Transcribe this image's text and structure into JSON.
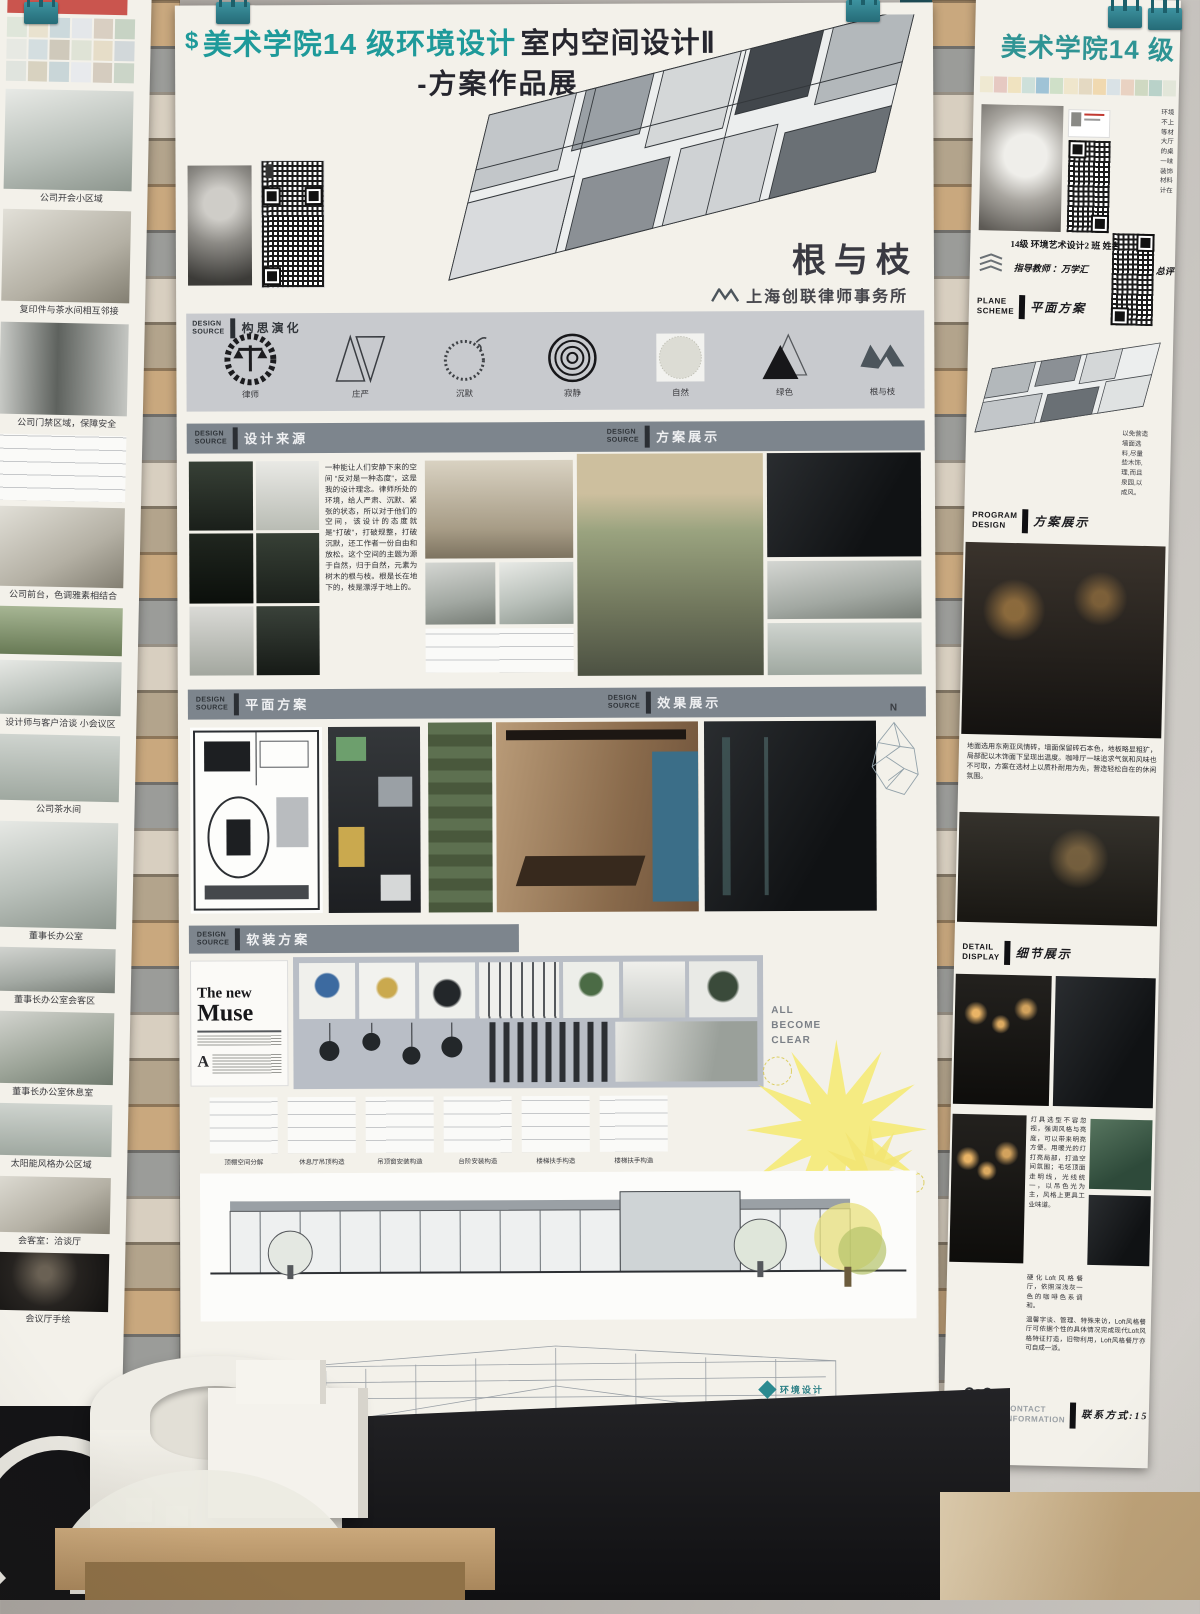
{
  "left_column": {
    "label": "INTERIOR DESIGN"
  },
  "right_column": {
    "label": "INTERIOR DESIGN"
  },
  "left_poster": {
    "captions": [
      "公司开会小区域",
      "复印件与茶水间相互邻接",
      "公司门禁区域，保障安全",
      "公司前台，色调雅素相结合",
      "设计师与客户洽谈 小会议区",
      "公司茶水间",
      "董事长办公室",
      "董事长办公室会客区",
      "董事长办公室休息室",
      "太阳能风格办公区域",
      "会客室：洽谈厅",
      "会议厅手绘"
    ]
  },
  "center_poster": {
    "brand_glyph": "$",
    "title_accent": "美术学院14 级环境设计",
    "title_main": "室内空间设计Ⅱ",
    "subtitle": "-方案作品展",
    "student_line1": "14级 环境艺术设计 2 班   姓名 马孝玲   学号 12140370209",
    "student_line2": "指导教师 万学汇      总评成绩",
    "project_name": "根与枝",
    "client_name": "上海创联律师事务所",
    "concept": {
      "en": "DESIGN\nSOURCE",
      "zh": "构思演化",
      "icons": [
        {
          "label": "律师"
        },
        {
          "label": "庄严"
        },
        {
          "label": "沉默"
        },
        {
          "label": "寂静"
        },
        {
          "label": "自然"
        },
        {
          "label": "绿色"
        },
        {
          "label": "根与枝"
        }
      ]
    },
    "sections": {
      "s1": {
        "en": "DESIGN\nSOURCE",
        "zh": "设计来源"
      },
      "s2": {
        "en": "DESIGN\nSOURCE",
        "zh": "方案展示"
      },
      "s3": {
        "en": "DESIGN\nSOURCE",
        "zh": "平面方案"
      },
      "s4": {
        "en": "DESIGN\nSOURCE",
        "zh": "效果展示"
      },
      "s5": {
        "en": "DESIGN\nSOURCE",
        "zh": "软装方案"
      }
    },
    "intro_text": "一种能让人们安静下来的空间 “反对是一种态度”，这是我的设计理念。律师所处的环境，给人严肃、沉默、紧张的状态，所以对于他们的空间，该设计的态度就是“打破”，打破规整，打破沉默，还工作者一份自由和放松。这个空间的主题为源于自然，归于自然，元素为树木的根与枝。根是长在地下的，枝是漂浮于地上的。",
    "magazine_title_1": "The new",
    "magazine_title_2": "Muse",
    "become_clear": "ALL\nBECOME\nCLEAR",
    "compass_n": "N",
    "detail_captions": [
      "顶棚空间分解",
      "休息厅吊顶构造",
      "吊顶窗安装构造",
      "台阶安装构造",
      "楼梯扶手构造",
      "楼梯扶手构造"
    ],
    "footer_logo": "环境设计"
  },
  "right_poster": {
    "title": "美术学院14 级",
    "concept_en": "CONC\nDESIG",
    "side_fragments_1": "环境\n不上\n等材\n大厅\n的桌\n一味\n装饰\n材料\n计在",
    "class_line": "14级 环境艺术设计2 班   姓名",
    "teacher_line": "指导教师 ：万学汇",
    "grade_label": "总评",
    "sections": {
      "plane": {
        "en": "PLANE\nSCHEME",
        "zh": "平面方案"
      },
      "program": {
        "en": "PROGRAM\nDESIGN",
        "zh": "方案展示"
      },
      "detail": {
        "en": "DETAIL\nDISPLAY",
        "zh": "细节展示"
      },
      "contact": {
        "en": "CONTACT\nINFORMATION",
        "zh": "联系方式:15101240"
      }
    },
    "side_fragments_2": "以免营造\n墙面选\n料,尽量\n些木饰,\n理,而且\n泉园,以\n成风。",
    "para_main": "地面选用东南亚风情砖，墙面保留砖石本色，地板略显粗犷，局部配以木饰面下呈现出温度。咖啡厅一味追求气氛和风味也不可取，方案在选材上以质朴耐用为先，营造轻松自在的休闲氛围。",
    "para_detail_1": "灯具选型不容忽视，强调风格与亮度，可以带来明亮方便。用暖光的灯打亮局部，打造空间氛围；毛坯顶面走明线，光线统一，以吊色光为主，风格上更具工业味道。",
    "para_detail_2": "硬化Loft风格餐厅，依照深浅灰一色的咖啡色系调和。",
    "para_detail_3": "温馨字谈、管理、特殊来访，Loft风格餐厅可依据个性的具体情况完成现代Loft风格特征打造，旧物利用，Loft风格餐厅亦可自成一派。"
  }
}
